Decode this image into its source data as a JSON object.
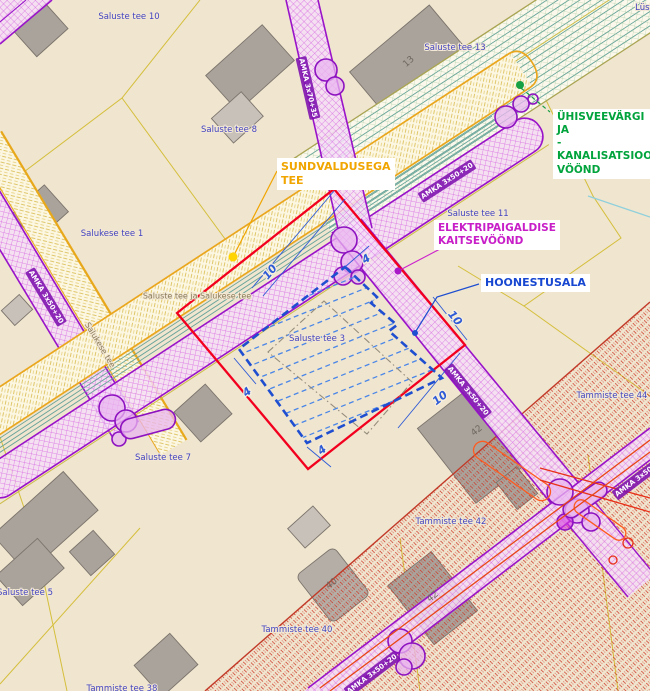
{
  "map": {
    "background_color": "#f0e5cf",
    "annotations": {
      "sundvaldusega": {
        "line1": "SUNDVALDUSEGA",
        "line2": "TEE",
        "color": "#f0a500"
      },
      "elektripaigaldise": {
        "line1": "ELEKTRIPAIGALDISE",
        "line2": "KAITSEVÖÖND",
        "color": "#c81ec8"
      },
      "hoonestusala": {
        "line1": "HOONESTUSALA",
        "color": "#1747d1"
      },
      "uhisveevargi": {
        "line1": "ÜHISVEEVÄRGI",
        "line2": "JA",
        "line3": "-KANALISATSIOONI",
        "line4": "VÖÖND",
        "color": "#00a33c"
      }
    },
    "address_labels": [
      {
        "text": "Saluste tee 10",
        "x": 129,
        "y": 17
      },
      {
        "text": "Saluste tee 8",
        "x": 229,
        "y": 130
      },
      {
        "text": "Saluste tee 13",
        "x": 455,
        "y": 48
      },
      {
        "text": "Salukese tee 1",
        "x": 112,
        "y": 234
      },
      {
        "text": "Saluste tee 11",
        "x": 478,
        "y": 214
      },
      {
        "text": "Saluste tee 3",
        "x": 317,
        "y": 339
      },
      {
        "text": "Saluste tee 7",
        "x": 163,
        "y": 458
      },
      {
        "text": "Saluste tee 5",
        "x": 25,
        "y": 593
      },
      {
        "text": "Tammiste tee 44",
        "x": 612,
        "y": 396
      },
      {
        "text": "Tammiste tee 42",
        "x": 451,
        "y": 522
      },
      {
        "text": "Tammiste tee 40",
        "x": 297,
        "y": 630
      },
      {
        "text": "Tammiste tee 38",
        "x": 122,
        "y": 689
      },
      {
        "text": "Lüst",
        "x": 644,
        "y": 8
      }
    ],
    "road_labels": [
      {
        "text": "Saluste tee ja Salukese tee",
        "x": 197,
        "y": 296,
        "rot": 0
      },
      {
        "text": "Salukese tee",
        "x": 100,
        "y": 345,
        "rot": 59
      }
    ],
    "cable_labels": [
      {
        "text": "AMKA 3x70+35",
        "x": 308,
        "y": 88,
        "rot": 77
      },
      {
        "text": "AMKA 3x50+20",
        "x": 447,
        "y": 181,
        "rot": -33
      },
      {
        "text": "AMKA 3x50+20",
        "x": 46,
        "y": 297,
        "rot": 59
      },
      {
        "text": "AMKA 3x50+20",
        "x": 468,
        "y": 391,
        "rot": 51
      },
      {
        "text": "AMKA 3x50+20",
        "x": 372,
        "y": 674,
        "rot": -37
      },
      {
        "text": "AMKA 3x50+20",
        "x": 640,
        "y": 477,
        "rot": -37
      }
    ],
    "building_labels": [
      {
        "text": "13",
        "x": 409,
        "y": 62,
        "rot": -42
      },
      {
        "text": "42",
        "x": 477,
        "y": 431,
        "rot": -38
      },
      {
        "text": "40",
        "x": 332,
        "y": 584,
        "rot": -38
      },
      {
        "text": "42",
        "x": 433,
        "y": 597,
        "rot": -38
      }
    ],
    "dimension_labels": [
      {
        "text": "10",
        "x": 270,
        "y": 272,
        "rot": -50
      },
      {
        "text": "4",
        "x": 366,
        "y": 259,
        "rot": -33
      },
      {
        "text": "10",
        "x": 455,
        "y": 318,
        "rot": 51
      },
      {
        "text": "10",
        "x": 440,
        "y": 398,
        "rot": -38
      },
      {
        "text": "4",
        "x": 247,
        "y": 392,
        "rot": -38
      },
      {
        "text": "4",
        "x": 322,
        "y": 450,
        "rot": -38
      }
    ],
    "legend_colors": {
      "planned_road_area": "#f2001e",
      "building_area": "#1f4fd0",
      "electrical_corridor": "#9913c9",
      "water_sewer_corridor": "#66a39a",
      "road_edge": "#eaa61d",
      "parcel_line": "#d4bf3b",
      "restriction_zone": "#cc3322",
      "building_fill": "#aaa39b",
      "address_text": "#4343c0"
    }
  }
}
